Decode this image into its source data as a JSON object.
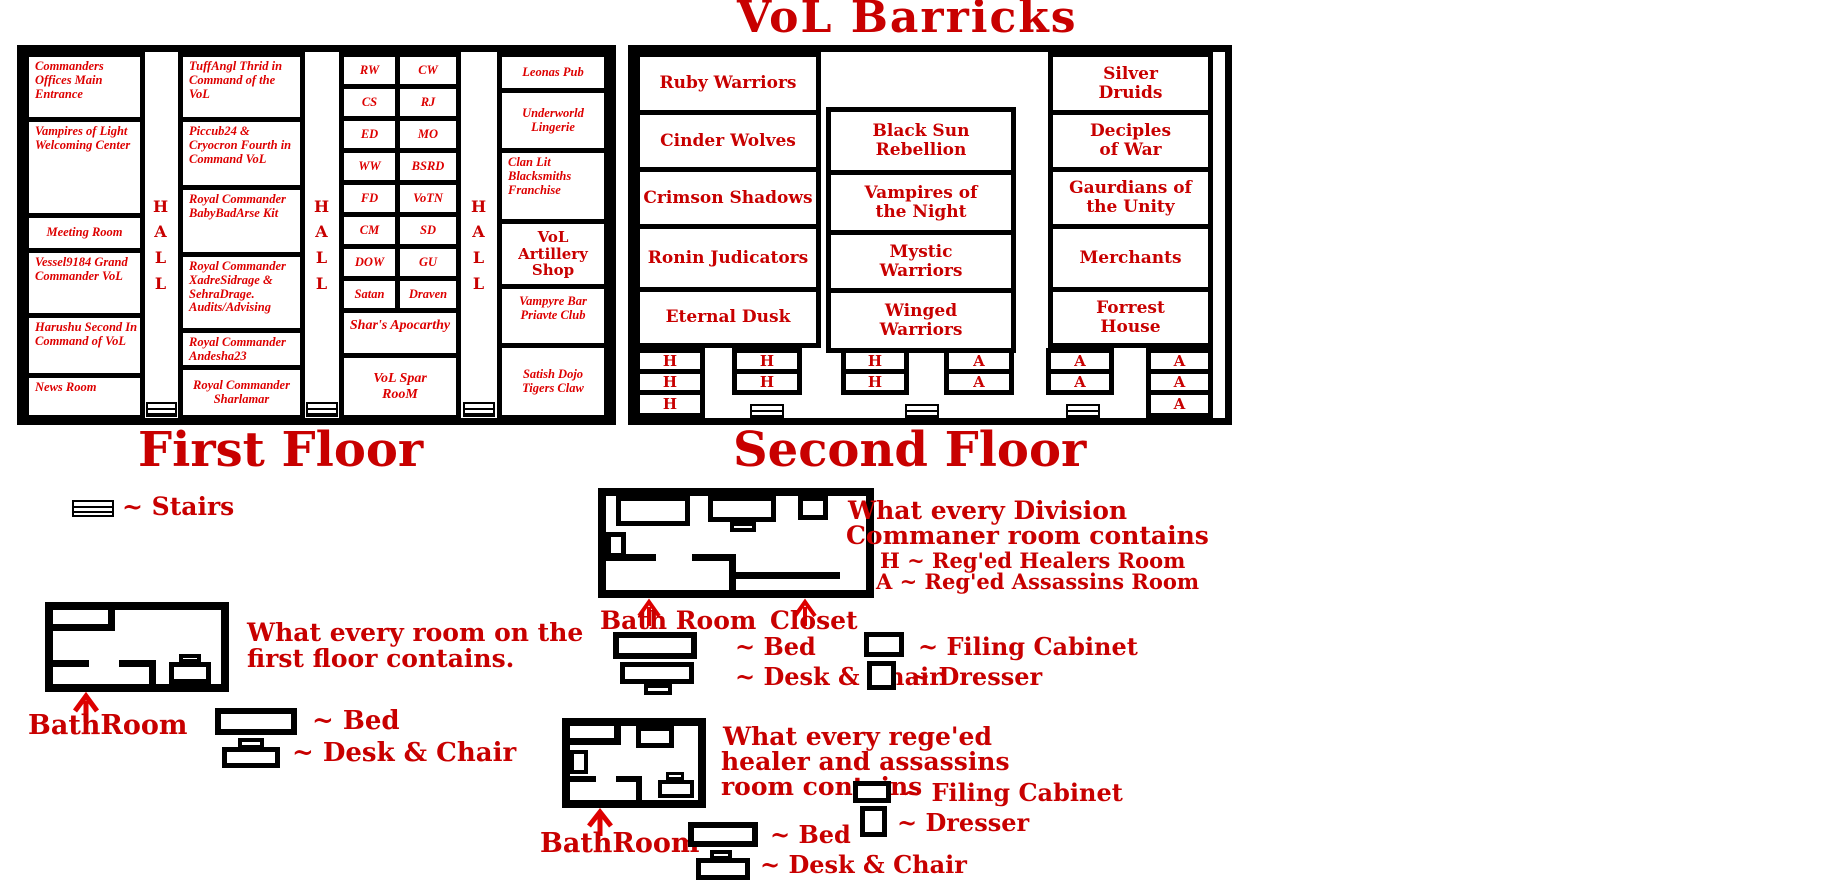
{
  "title": "VoL Barricks",
  "palette": {
    "wall": "#000000",
    "blackletter_red": "#c80000",
    "italic_red": "#dd0000",
    "background": "#ffffff"
  },
  "floor1": {
    "heading": "First Floor",
    "hall": "HALL",
    "col1": [
      "Commanders Offices Main Entrance",
      "Vampires of Light Welcoming Center",
      "Meeting Room",
      "Vessel9184 Grand Commander VoL",
      "Harushu Second In Command of VoL",
      "News Room"
    ],
    "col2": [
      "TuffAngl Thrid in Command of the VoL",
      "Piccub24 & Cryocron Fourth in Command VoL",
      "Royal Commander BabyBadArse Kit",
      "Royal Commander XadreSidrage & SehraDrage. Audits/Advising",
      "Royal Commander Andesha23",
      "Royal Commander Sharlamar"
    ],
    "col3_left": [
      "RW",
      "CS",
      "ED",
      "WW",
      "FD",
      "CM",
      "DOW",
      "Satan"
    ],
    "col3_right": [
      "CW",
      "RJ",
      "MO",
      "BSRD",
      "VoTN",
      "SD",
      "GU",
      "Draven"
    ],
    "col3_wide": [
      "Shar's Apocarthy",
      "VoL Spar RooM"
    ],
    "col4": [
      "Leonas Pub",
      "Underworld Lingerie",
      "Clan Lit Blacksmiths Franchise",
      "VoL Artillery Shop",
      "Vampyre Bar Priavte Club",
      "Satish Dojo Tigers Claw"
    ]
  },
  "floor2": {
    "heading": "Second Floor",
    "left": [
      "Ruby Warriors",
      "Cinder Wolves",
      "Crimson Shadows",
      "Ronin Judicators",
      "Eternal Dusk"
    ],
    "middle": [
      "Black Sun Rebellion",
      "Vampires of the Night",
      "Mystic Warriors",
      "Winged Warriors"
    ],
    "right": [
      "Silver Druids",
      "Deciples of War",
      "Gaurdians of the Unity",
      "Merchants",
      "Forrest House"
    ],
    "healer_abbr": "H",
    "assassin_abbr": "A"
  },
  "legend": {
    "stairs_label": "~ Stairs",
    "first_room": {
      "line1": "What every room on the",
      "line2": "first floor contains.",
      "bathroom": "BathRoom",
      "bed": "~ Bed",
      "desk": "~ Desk & Chair"
    },
    "commander_room": {
      "line1": "What every Division",
      "line2": "Commaner room contains",
      "healer_key": "H ~ Reg'ed Healers Room",
      "assassin_key": "A ~ Reg'ed Assassins Room",
      "bathroom": "Bath Room",
      "closet": "Closet",
      "bed": "~ Bed",
      "desk": "~ Desk & Chair",
      "filing": "~ Filing Cabinet",
      "dresser": "~ Dresser"
    },
    "healer_room": {
      "line1": "What every rege'ed",
      "line2": "healer and assassins",
      "line3": "room contains",
      "bathroom": "BathRoom",
      "bed": "~ Bed",
      "desk": "~ Desk & Chair",
      "filing": "~ Filing Cabinet",
      "dresser": "~ Dresser"
    }
  }
}
